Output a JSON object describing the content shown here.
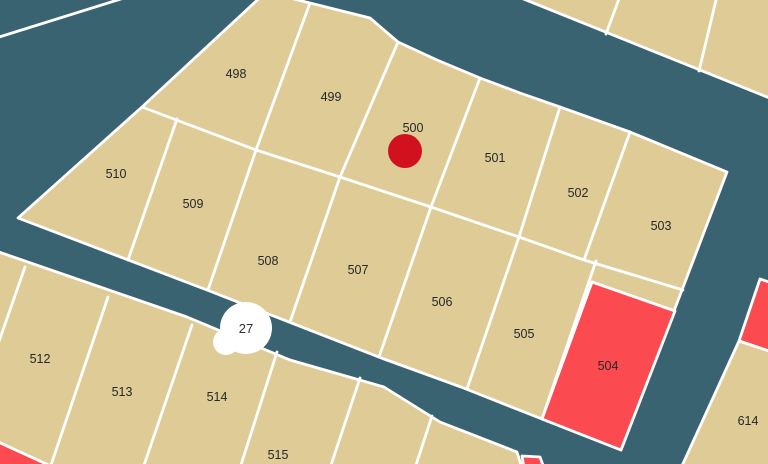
{
  "app": {
    "type": "parcel-map-view"
  },
  "labels": {
    "l498": "498",
    "l499": "499",
    "l500": "500",
    "l501": "501",
    "l502": "502",
    "l503": "503",
    "l504": "504",
    "l505": "505",
    "l506": "506",
    "l507": "507",
    "l508": "508",
    "l509": "509",
    "l510": "510",
    "l512": "512",
    "l513": "513",
    "l514": "514",
    "l515": "515",
    "l614": "614",
    "cluster_count": "27"
  },
  "colors": {
    "road": "#3a6371",
    "parcel": "#decb96",
    "highlight_parcel": "#fb4a50",
    "marker": "#d2111f",
    "boundary": "#ffffff",
    "cluster_bg": "#ffffff",
    "label_text": "#26282a"
  }
}
